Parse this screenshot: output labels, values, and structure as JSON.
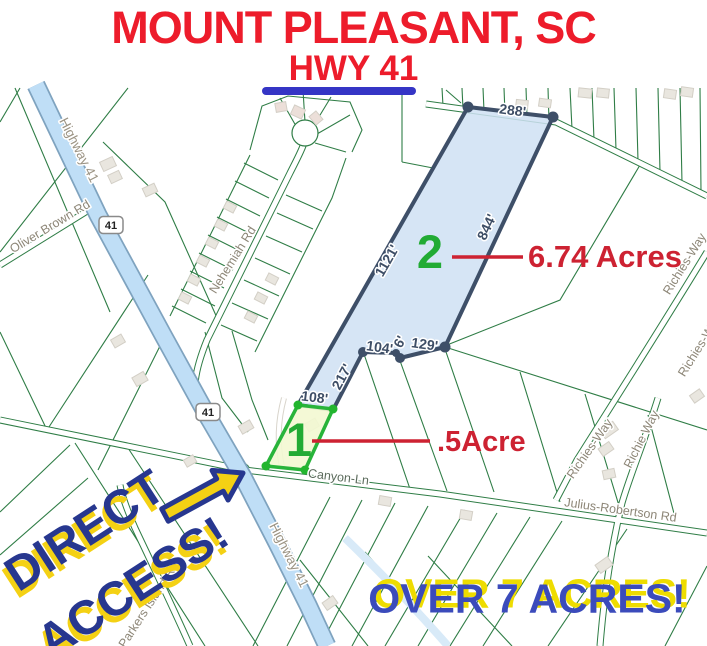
{
  "header": {
    "title": "MOUNT PLEASANT, SC",
    "subtitle": "HWY 41"
  },
  "parcels": {
    "parcel2": {
      "number": "2",
      "acreage": "6.74 Acres",
      "dims": {
        "top": "288'",
        "right": "844'",
        "left": "1121'",
        "bottom_a": "104'",
        "bottom_b": "6'",
        "bottom_c": "129'",
        "southwest": "217'"
      }
    },
    "parcel1": {
      "number": "1",
      "acreage": ".5Acre",
      "dims": {
        "top": "108'"
      }
    }
  },
  "roads": {
    "highway": "Highway 41",
    "shield": "41",
    "oliver_brown": "Oliver Brown Rd",
    "nehemiah": "Nehemiah Rd",
    "canyon": "Canyon-Ln",
    "julius": "Julius-Robertson Rd",
    "richies_way": "Richies-Way",
    "richie_way": "Richie Way",
    "parkers_island": "Parkers Island Rd"
  },
  "callouts": {
    "direct_line1": "DIRECT",
    "direct_line2": "ACCESS!",
    "over": "OVER 7 ACRES!"
  },
  "colors": {
    "title_red": "#ed1c2b",
    "underline_blue": "#3535c5",
    "annotation_red": "#cd2232",
    "parcel2_fill": "#cfe1f3",
    "parcel2_stroke": "#3e4f68",
    "parcel1_fill": "#f3f8d2",
    "parcel1_stroke": "#28b43a",
    "parcel_number_green": "#22ab34",
    "callout_blue": "#27378f",
    "callout_yellow": "#f4d114",
    "highway_fill": "#bfdef6",
    "map_line_green": "#2f7d46"
  }
}
